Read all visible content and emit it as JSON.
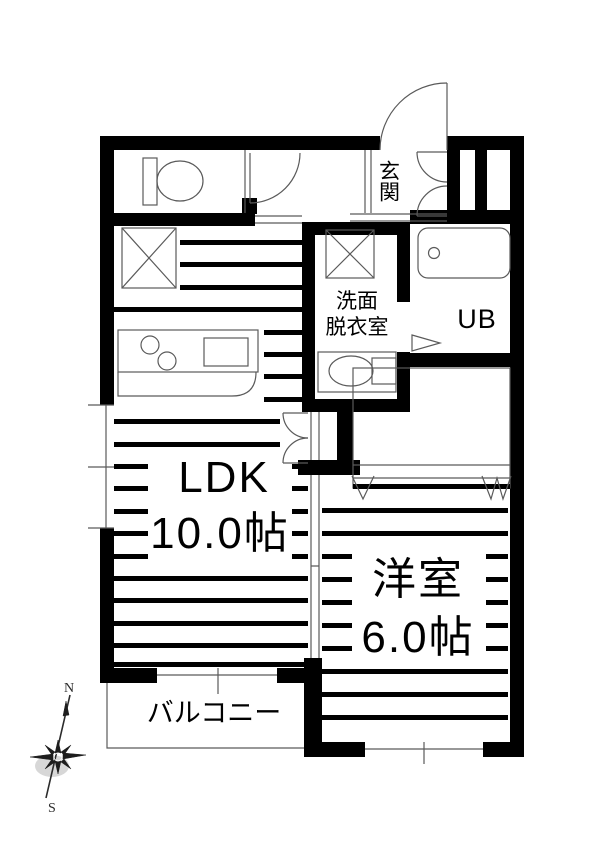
{
  "floor_plan": {
    "rooms": {
      "entrance": {
        "label": "玄関"
      },
      "washroom": {
        "label_lines": [
          "洗面",
          "脱衣室"
        ]
      },
      "unit_bath": {
        "label": "UB"
      },
      "ldk": {
        "label": "LDK",
        "area": "10.0帖"
      },
      "western_room": {
        "label": "洋室",
        "area": "6.0帖"
      },
      "balcony": {
        "label": "バルコニー"
      }
    },
    "compass": {
      "north_label": "N",
      "south_label": "S"
    },
    "colors": {
      "wall": "#000000",
      "line": "#5a5a5a",
      "text": "#000000",
      "background": "#ffffff"
    },
    "fixtures": [
      "toilet",
      "bathtub",
      "washbasin",
      "kitchen-counter",
      "washing-machine-space",
      "refrigerator-space",
      "closet-hanger",
      "sliding-door",
      "folding-door",
      "entrance-door",
      "shoe-cabinet"
    ]
  }
}
